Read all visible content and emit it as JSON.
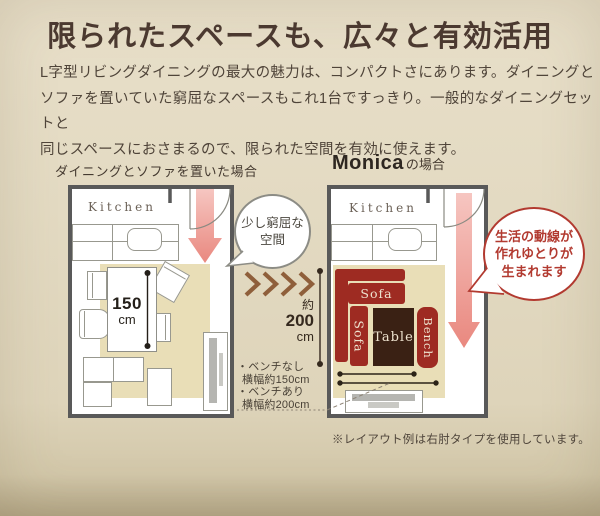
{
  "header": {
    "title": "限られたスペースも、広々と有効活用",
    "description_lines": [
      "L字型リビングダイニングの最大の魅力は、コンパクトさにあります。ダイニングと",
      "ソファを置いていた窮屈なスペースもこれ1台ですっきり。一般的なダイニングセットと",
      "同じスペースにおさまるので、限られた空間を有効に使えます。"
    ]
  },
  "before": {
    "caption": "ダイニングとソファを置いた場合",
    "kitchen_label": "Kitchen",
    "table_length": {
      "value": "150",
      "unit": "cm"
    },
    "bubble_lines": [
      "少し窮屈な",
      "空間"
    ]
  },
  "after": {
    "caption_brand": "Monica",
    "caption_suffix": "の場合",
    "kitchen_label": "Kitchen",
    "furniture": {
      "sofa_top": "Sofa",
      "sofa_left": "Sofa",
      "table": "Table",
      "bench": "Bench"
    },
    "depth_label": {
      "approx": "約",
      "value": "200",
      "unit": "cm"
    },
    "notes_lines": [
      "・ベンチなし",
      "横幅約150cm",
      "・ベンチあり",
      "横幅約200cm"
    ],
    "bubble_lines": [
      "生活の動線が",
      "作れゆとりが",
      "生まれます"
    ]
  },
  "footnote": "※レイアウト例は右肘タイプを使用しています。",
  "colors": {
    "background": "#e2d9c1",
    "title_text": "#4b3930",
    "wall_gray": "#595959",
    "rug_beige": "#e9deb7",
    "sofa_red": "#9e2b22",
    "table_brown": "#3a2114",
    "arrow_pink": "#ef9f9a",
    "chevron_brown": "#8f5f3b",
    "bubble_gray": "#8c8c85",
    "bubble_red": "#b23a30"
  }
}
